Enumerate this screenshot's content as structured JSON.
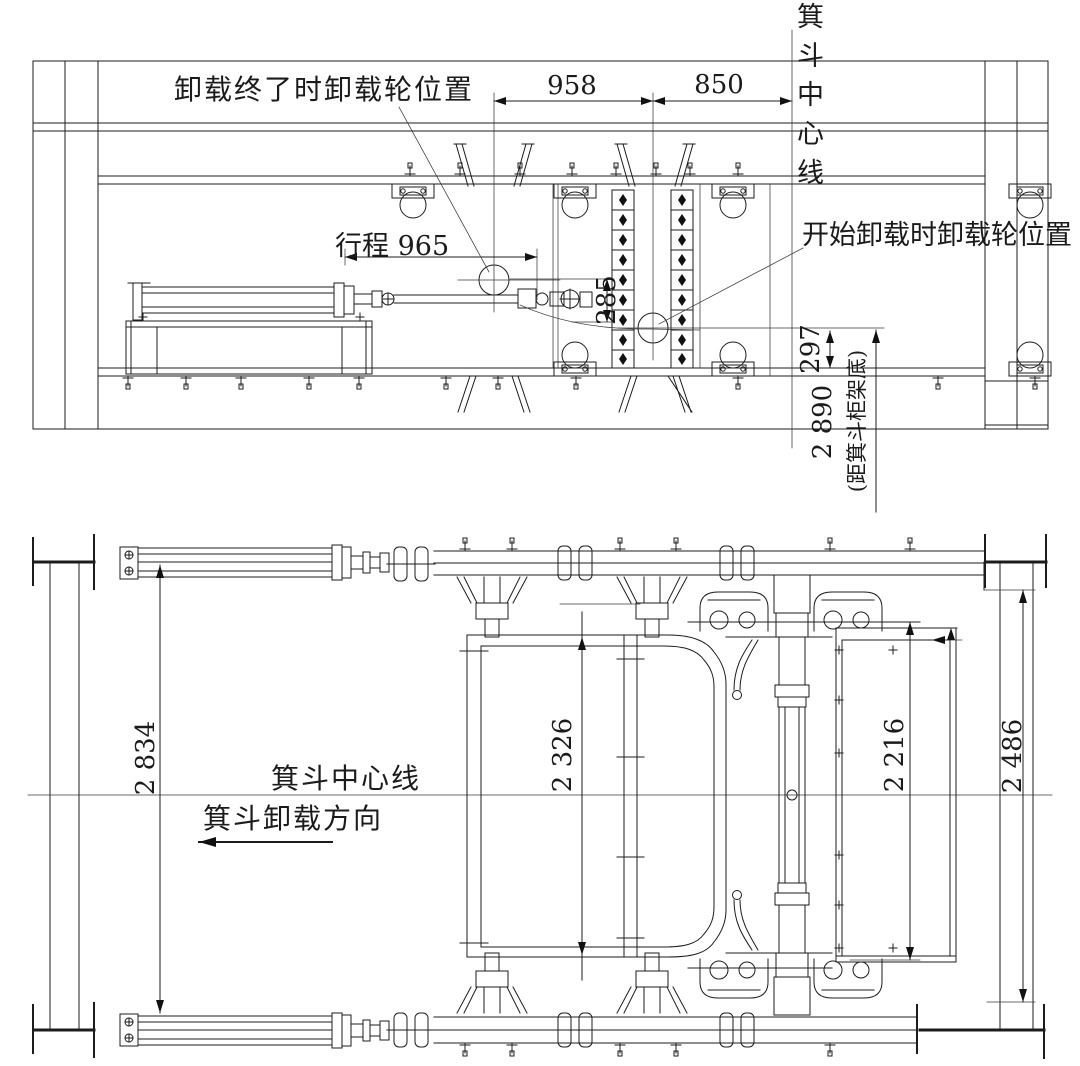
{
  "top_view": {
    "end_unload_label": "卸载终了时卸载轮位置",
    "start_unload_label": "开始卸载时卸载轮位置",
    "skip_centerline_label": "箕斗中心线",
    "dims": {
      "span_left": "958",
      "span_right": "850",
      "stroke": "行程 965",
      "wheel_drop": "285",
      "wheel_offset": "297",
      "to_skip_frame_bottom": "2 890",
      "to_skip_frame_bottom_note": "(距箕斗柜架底)"
    }
  },
  "bottom_view": {
    "skip_centerline_label": "箕斗中心线",
    "unload_direction_label": "箕斗卸载方向",
    "dims": {
      "rail_span": "2 834",
      "skip_body_width": "2 326",
      "chute_frame_width": "2 216",
      "outer_frame_width": "2 486"
    }
  }
}
